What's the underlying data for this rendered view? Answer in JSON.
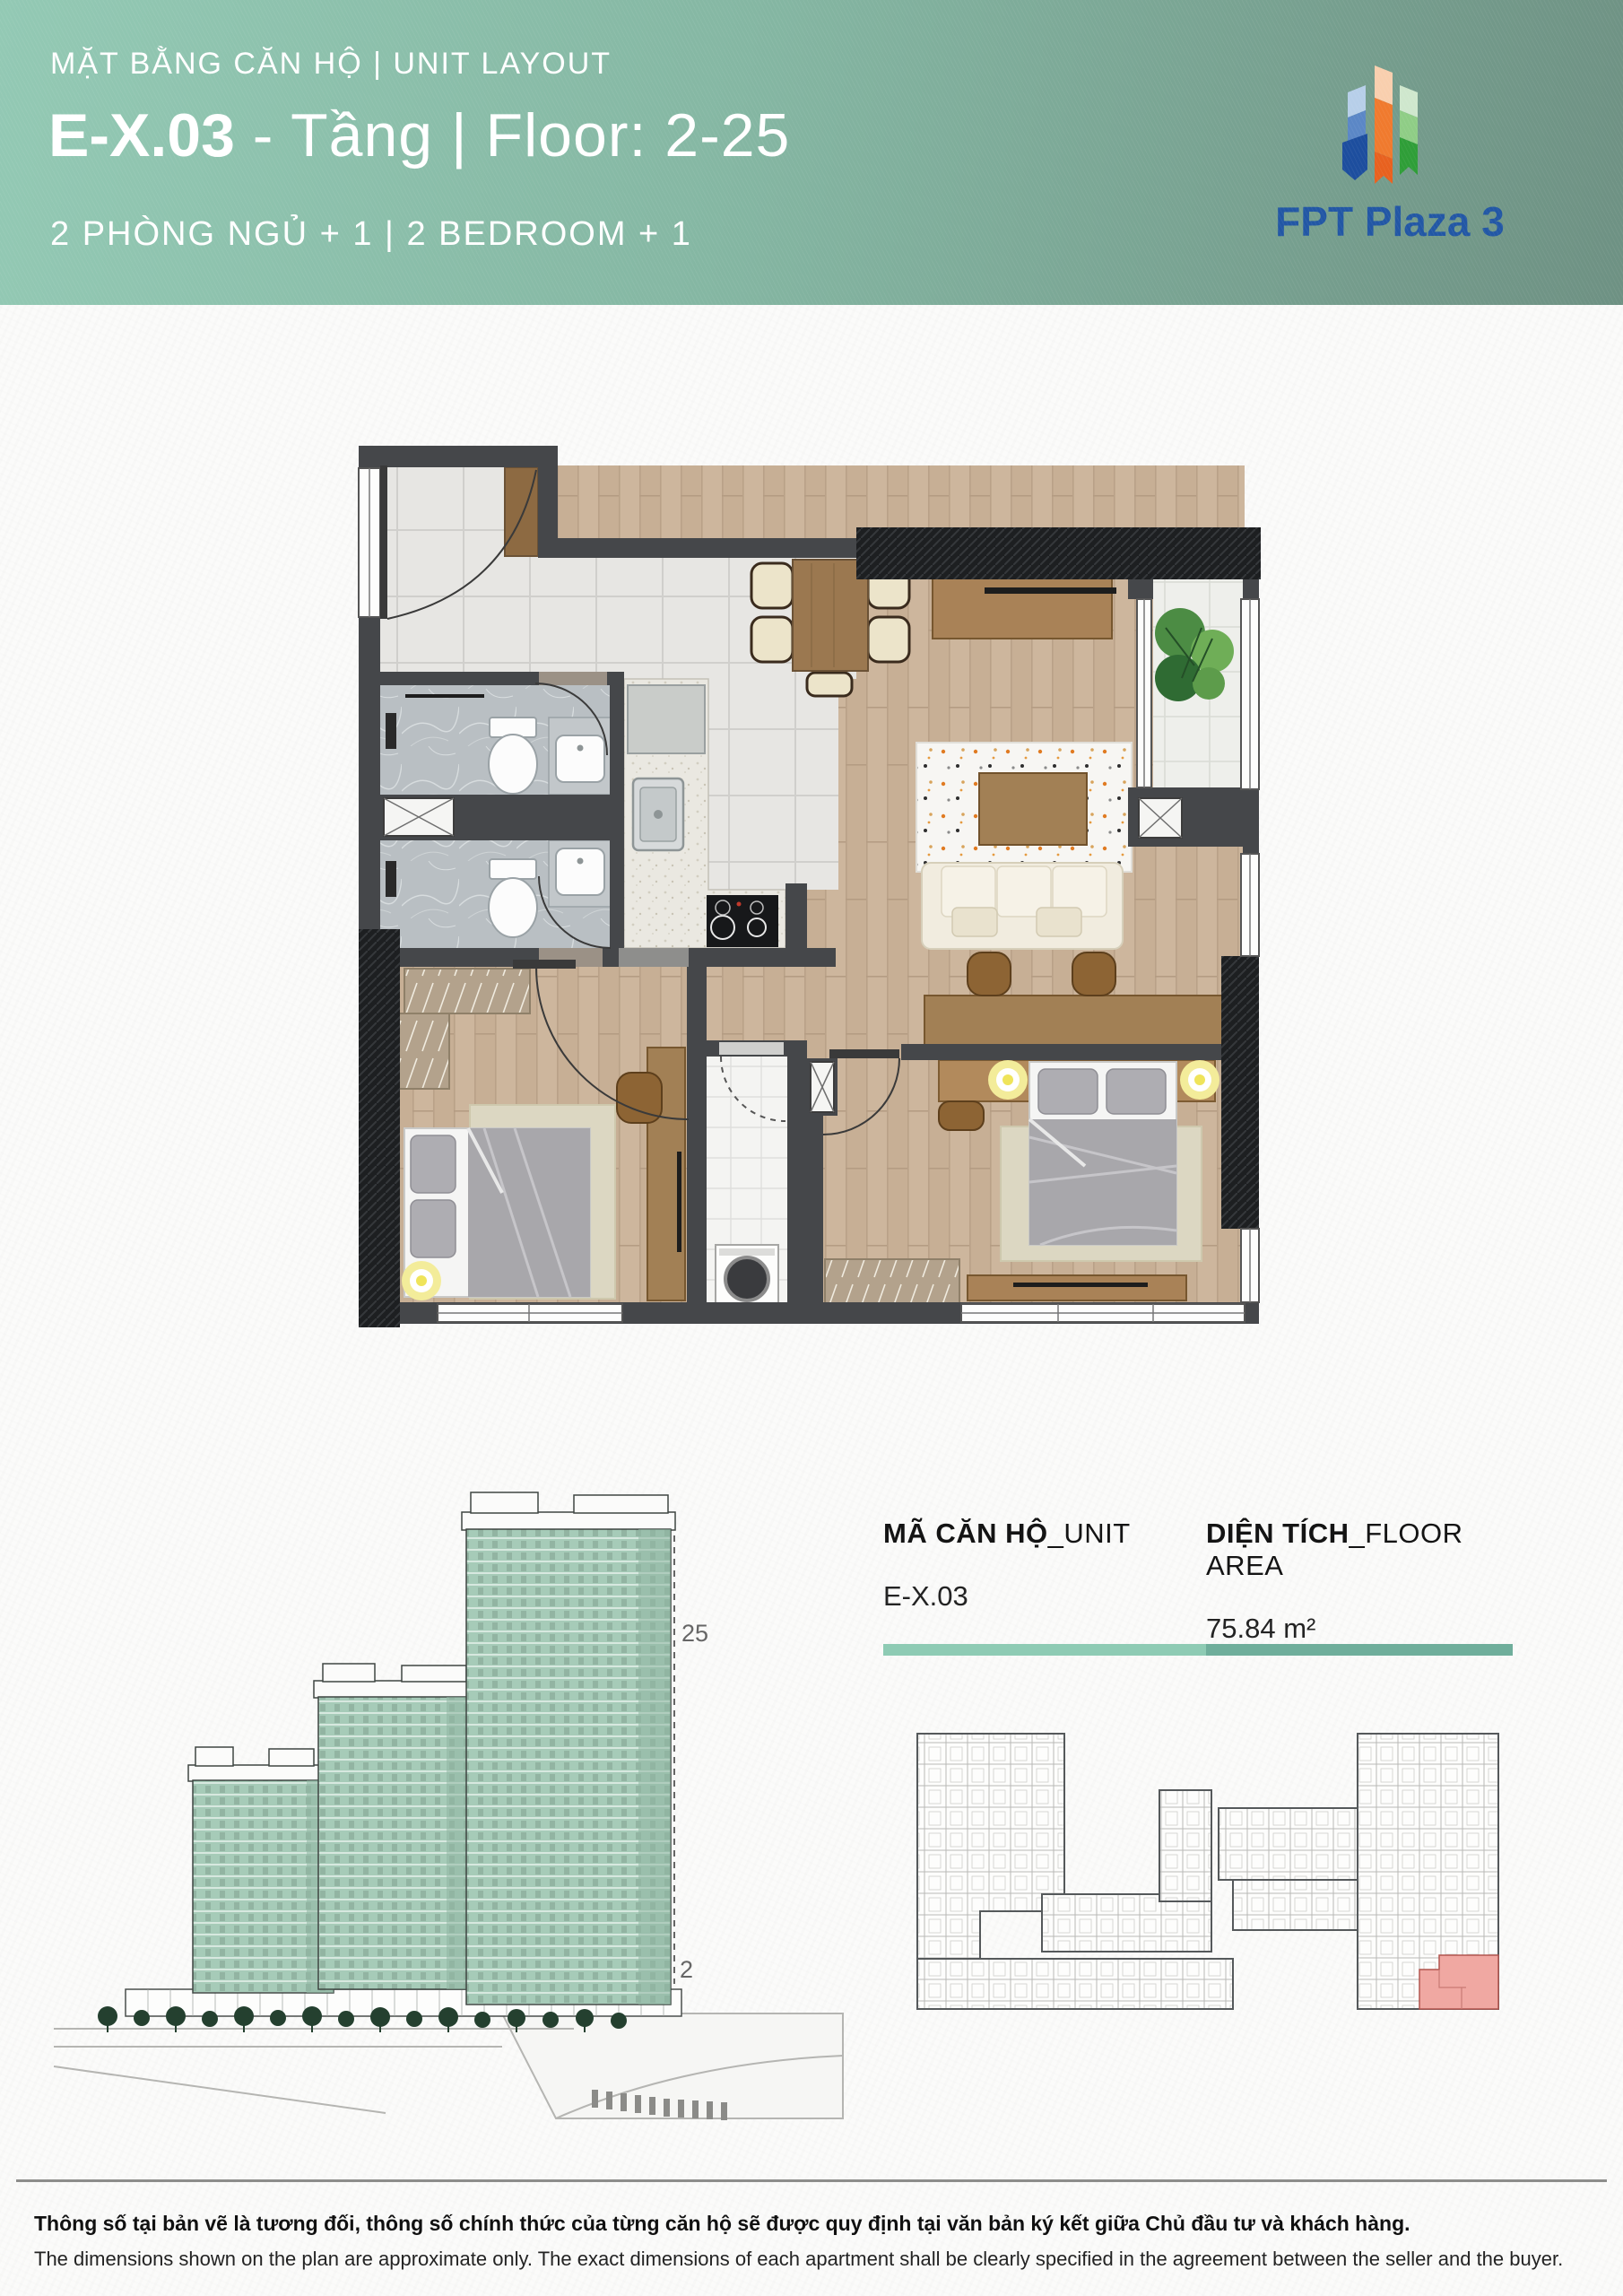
{
  "header": {
    "subtitle": "MẶT BẰNG CĂN HỘ | UNIT LAYOUT",
    "unit_code": "E-X.03",
    "title_rest": " - Tầng | Floor: 2-25",
    "bedroom_line": "2 PHÒNG NGỦ + 1 | 2 BEDROOM + 1",
    "logo_text": "FPT Plaza 3"
  },
  "unit_info": {
    "unit_label": "MÃ CĂN HỘ",
    "unit_label_suffix": "_UNIT",
    "unit_code": "E-X.03",
    "area_label": "DIỆN TÍCH",
    "area_label_suffix": "_FLOOR AREA",
    "area_value": "75.84 m²"
  },
  "building": {
    "top_floor_label": "25",
    "bottom_floor_label": "2"
  },
  "footer": {
    "line_vi": "Thông số tại bản vẽ là tương đối, thông số chính thức của từng căn hộ sẽ được quy định tại văn bản ký kết giữa Chủ đầu tư và khách hàng.",
    "line_en": "The dimensions shown on the plan are approximate only. The exact dimensions of each apartment shall be clearly specified in the agreement between the seller and the buyer."
  },
  "colors": {
    "header_gradient_start": "#93c9b4",
    "header_gradient_end": "#6e9183",
    "accent_bar_light": "#8ecbb4",
    "accent_bar_dark": "#6fae9b",
    "logo_blue": "#2257a5",
    "tower_teal": "#a6cbb8",
    "highlight_unit_pink": "#f0a8a2",
    "wall_gray": "#45474a",
    "wood_floor": "#cdb69d"
  }
}
